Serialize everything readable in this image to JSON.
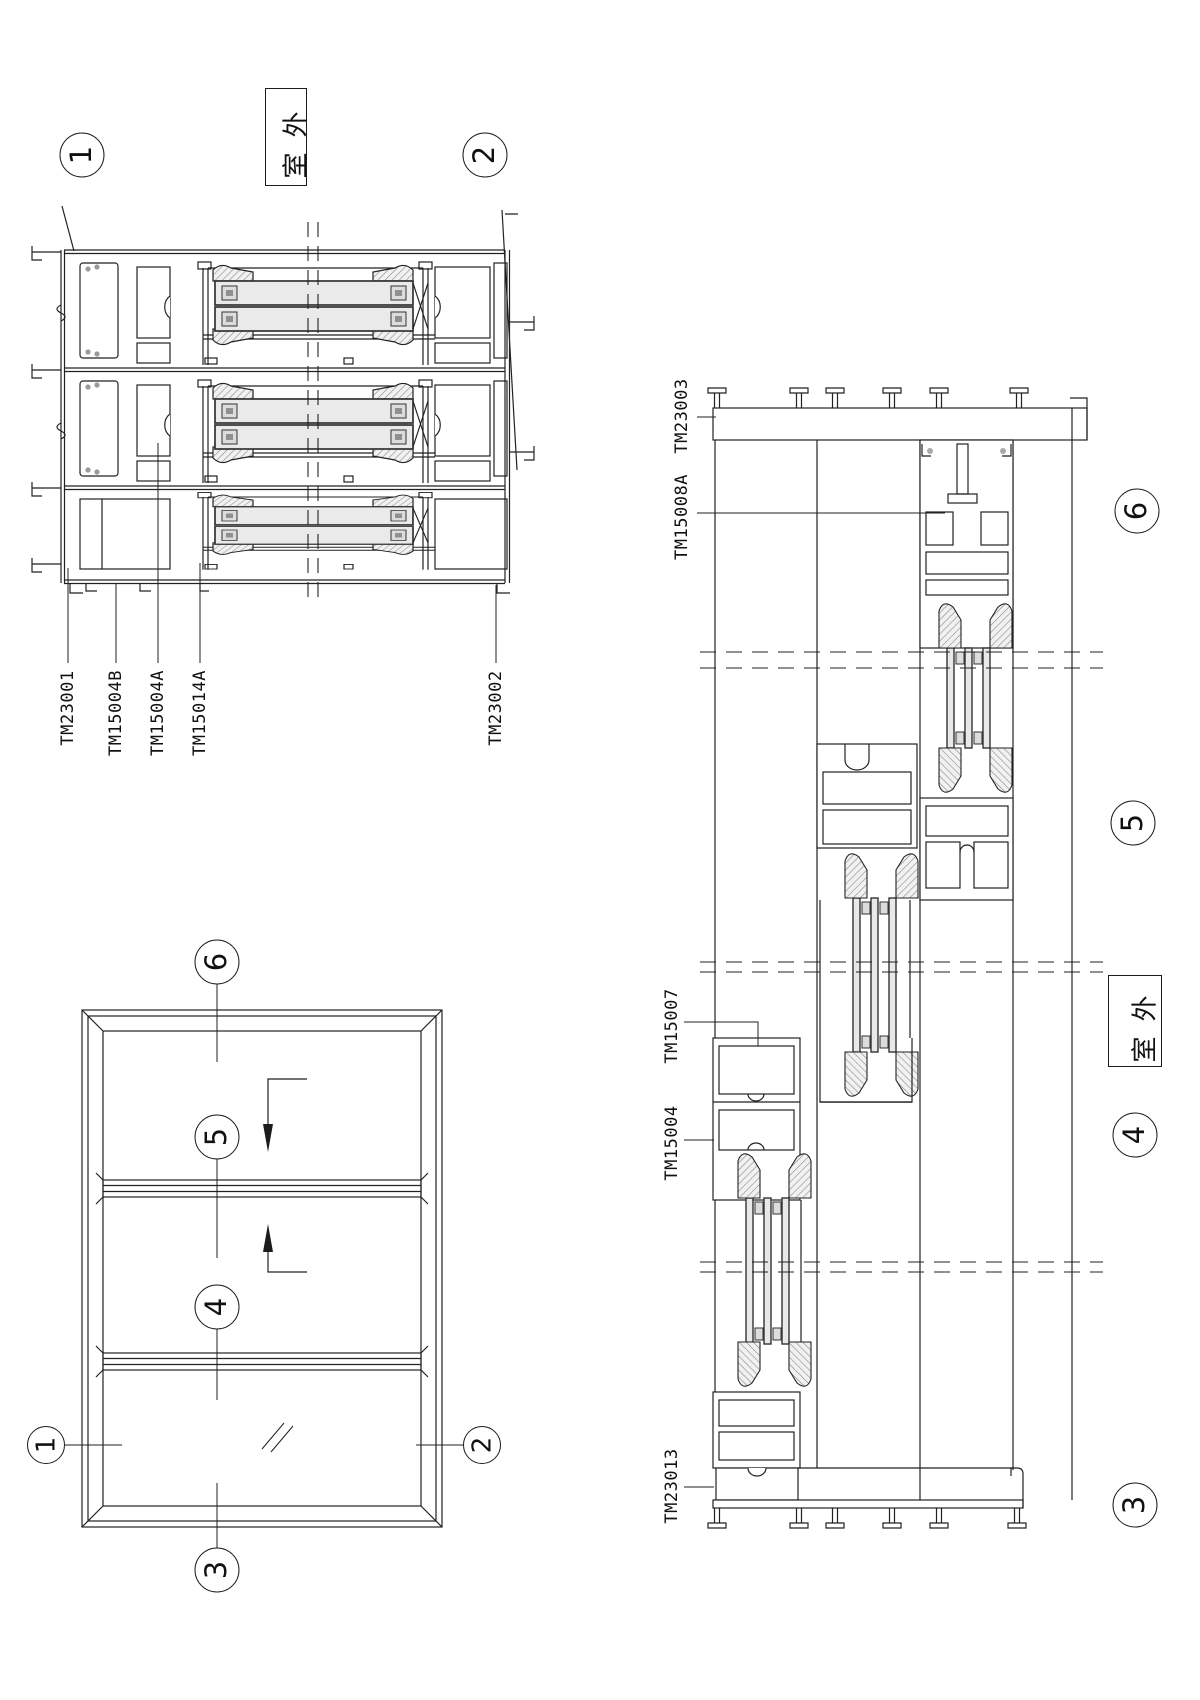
{
  "plan_section": {
    "callout_left": "1",
    "callout_right": "2",
    "outdoor": "室外",
    "labels": {
      "l1": "TM23001",
      "l2": "TM15004B",
      "l3": "TM15004A",
      "l4": "TM15014A",
      "l5": "TM23002"
    }
  },
  "elevation": {
    "callout_top": "6",
    "callout_mid_upper": "5",
    "callout_mid_lower": "4",
    "callout_left": "1",
    "callout_right": "2",
    "callout_bottom": "3"
  },
  "vertical_section": {
    "outdoor": "室外",
    "labels": {
      "l1": "TM23003",
      "l2": "TM15008A",
      "l3": "TM15007",
      "l4": "TM15004",
      "l5": "TM23013"
    },
    "callout_6": "6",
    "callout_5": "5",
    "callout_4": "4",
    "callout_3": "3"
  }
}
